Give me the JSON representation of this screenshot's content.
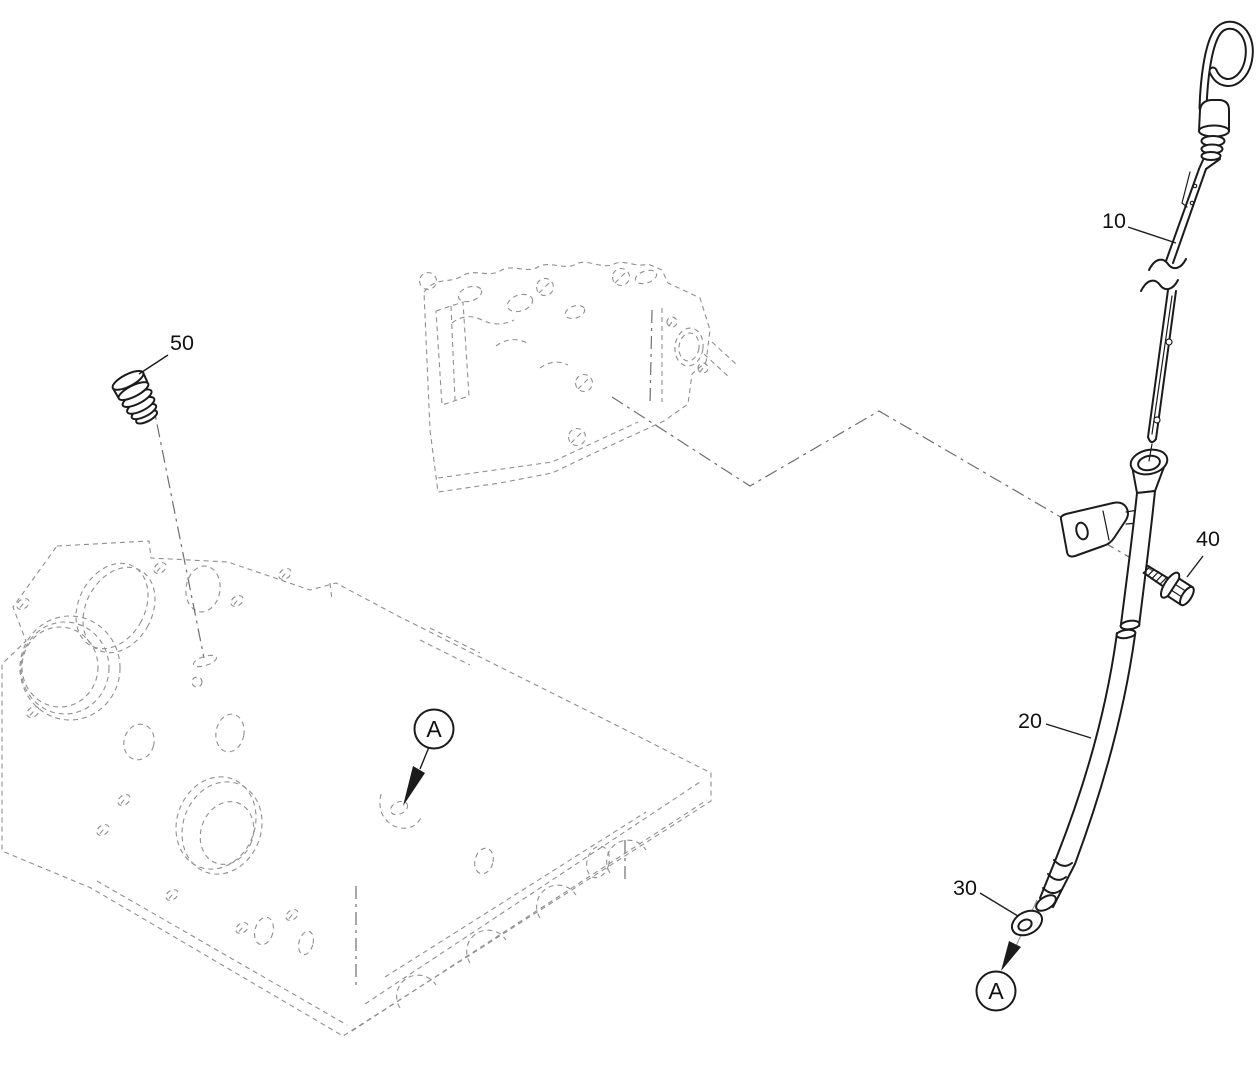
{
  "diagram": {
    "colors": {
      "background": "#ffffff",
      "part_line": "#1b1b1b",
      "ghost_line": "#8f8f8f"
    },
    "callouts": {
      "c10": "10",
      "c20": "20",
      "c30": "30",
      "c40": "40",
      "c50": "50"
    },
    "view_markers": {
      "m1": "A",
      "m2": "A"
    }
  }
}
